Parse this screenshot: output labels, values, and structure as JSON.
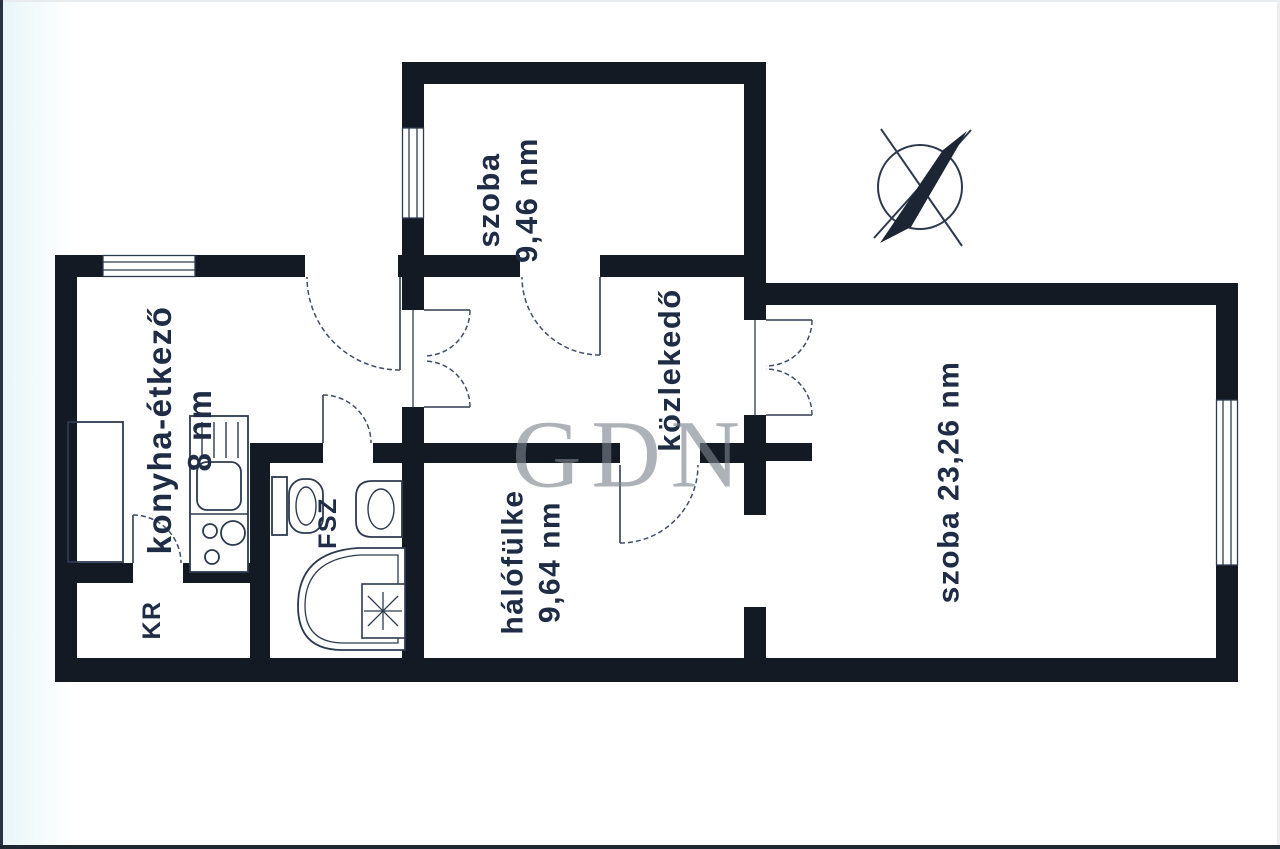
{
  "colors": {
    "wall": "#141a23",
    "line": "#2e3c52",
    "door_arc": "#3d4d68",
    "label": "#1e2c45",
    "watermark": "#7b828d",
    "background": "#ffffff"
  },
  "watermark": {
    "text": "GDN"
  },
  "compass": {
    "icon": "compass-north-arrow"
  },
  "rooms": {
    "szoba_top": {
      "line1": "szoba",
      "line2": "9,46 nm"
    },
    "konyha": {
      "line1": "konyha-étkező",
      "line2": "8 nm"
    },
    "kozlekedo": {
      "line1": "közlekedő"
    },
    "halofulke": {
      "line1": "hálófülke",
      "line2": "9,64 nm"
    },
    "szoba_nagy": {
      "line1": "szoba 23,26 nm"
    },
    "fsz": {
      "line1": "FSZ"
    },
    "kr": {
      "line1": "KR"
    }
  },
  "fixtures": {
    "kitchen_counter": "counter",
    "kitchen_unit": "sink-drainer-and-stove",
    "toilet": "toilet",
    "basin": "washbasin",
    "bathtub": "corner-bathtub",
    "heater": "water-heater-star"
  }
}
